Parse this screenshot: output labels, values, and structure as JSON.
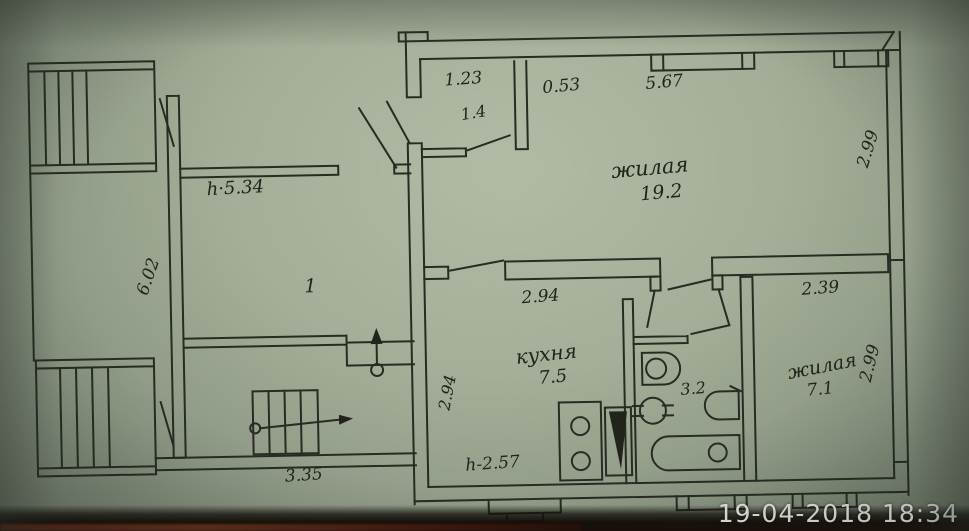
{
  "photo": {
    "timestamp": "19-04-2018 18:34"
  },
  "colors": {
    "paper": "#a7b09b",
    "ink": "#272b22",
    "stamp_text": "#ecebe7",
    "table_edge": "#72331c"
  },
  "plan": {
    "rooms": [
      {
        "name": "жилая",
        "area": "19.2"
      },
      {
        "name": "кухня",
        "area": "7.5"
      },
      {
        "area": "3.2"
      },
      {
        "name": "жилая",
        "area": "7.1"
      },
      {
        "name": "1"
      }
    ],
    "dimensions": {
      "entry_width": "1.23",
      "top_small": "0.53",
      "facade_top": "5.67",
      "entry_depth": "1.4",
      "right_upper": "2.99",
      "hall_width": "h·5.34",
      "hall_depth": "6.02",
      "kitchen_wall": "2.94",
      "kitchen_depth": "2.94",
      "room_wall": "2.39",
      "right_lower": "2.99",
      "stair_width": "3.35",
      "ceiling_height": "h-2.57"
    }
  }
}
